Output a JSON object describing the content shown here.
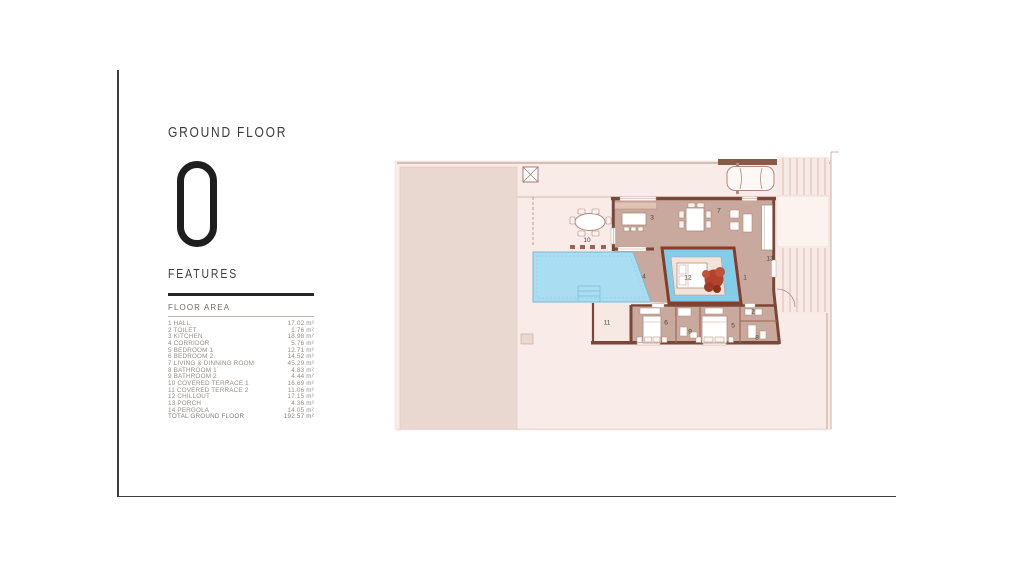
{
  "panel": {
    "floor_label": "GROUND FLOOR",
    "floor_number": "0",
    "features_label": "FEATURES",
    "floor_area_title": "FLOOR AREA",
    "rows": [
      {
        "name": "1 HALL",
        "area": "17.02 m²"
      },
      {
        "name": "2 TOILET",
        "area": "1.76 m²"
      },
      {
        "name": "3 KITCHEN",
        "area": "18.98 m²"
      },
      {
        "name": "4 CORRIDOR",
        "area": "5.76 m²"
      },
      {
        "name": "5 BEDROOM 1",
        "area": "12.71 m²"
      },
      {
        "name": "6 BEDROOM 2",
        "area": "14.52 m²"
      },
      {
        "name": "7 LIVING & DINNING ROOM",
        "area": "45.29 m²"
      },
      {
        "name": "8 BATHROOM 1",
        "area": "4.83 m²"
      },
      {
        "name": "9 BATHROOM 2",
        "area": "4.44 m²"
      },
      {
        "name": "10 COVERED TERRACE 1",
        "area": "16.69 m²"
      },
      {
        "name": "11 COVERED TERRACE 2",
        "area": "11.06 m²"
      },
      {
        "name": "12 CHILLOUT",
        "area": "17.15 m²"
      },
      {
        "name": "13 PORCH",
        "area": "4.36 m²"
      },
      {
        "name": "14 PERGOLA",
        "area": "14.05 m²"
      }
    ],
    "total": {
      "name": "TOTAL GROUND FLOOR",
      "area": "192.57 m²"
    }
  },
  "plan": {
    "room_labels": [
      "1",
      "2",
      "3",
      "4",
      "5",
      "6",
      "7",
      "8",
      "9",
      "10",
      "11",
      "12",
      "13"
    ],
    "colors": {
      "ground": "#f8ebe8",
      "garden": "#e9d8d0",
      "floor": "#c9a89d",
      "wall": "#7a4736",
      "pool": "#a9ddf1",
      "courtyard_water": "#82cdea",
      "courtyard_wall": "#8a3a28",
      "tree": "#b5432c",
      "deck_line": "#cfa08d"
    }
  }
}
